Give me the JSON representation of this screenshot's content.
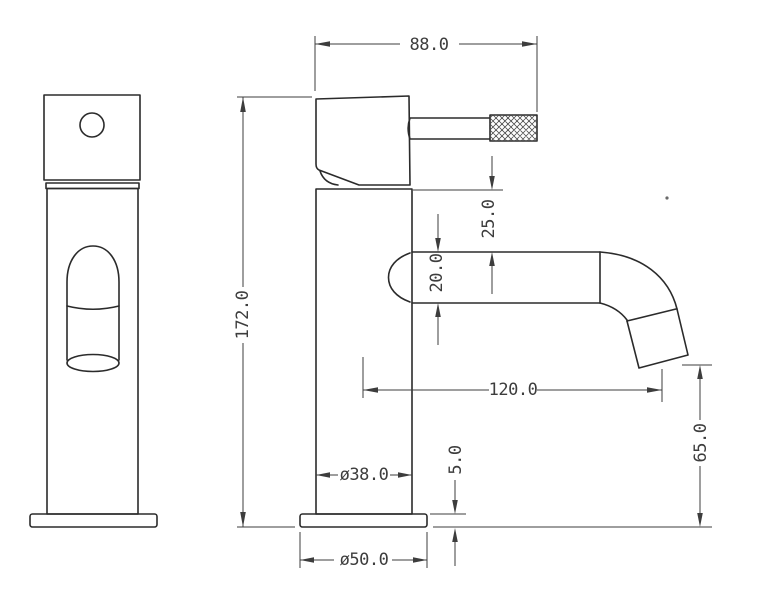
{
  "drawing": {
    "kind": "two-view technical drawing of a basin tap (faucet)",
    "views": {
      "front_view_name": "front-view",
      "side_view_name": "side-view"
    }
  },
  "colors": {
    "background": "#ffffff",
    "line": "#2b2b2b",
    "dimension": "#3d3d3d",
    "text": "#3d3d3d"
  },
  "dimensions": {
    "overall_width": "88.0",
    "overall_height": "172.0",
    "handle_to_spout": "25.0",
    "spout_tube": "20.0",
    "spout_reach": "120.0",
    "outlet_height": "65.0",
    "base_thickness": "5.0",
    "body_diameter": "ø38.0",
    "base_diameter": "ø50.0"
  }
}
